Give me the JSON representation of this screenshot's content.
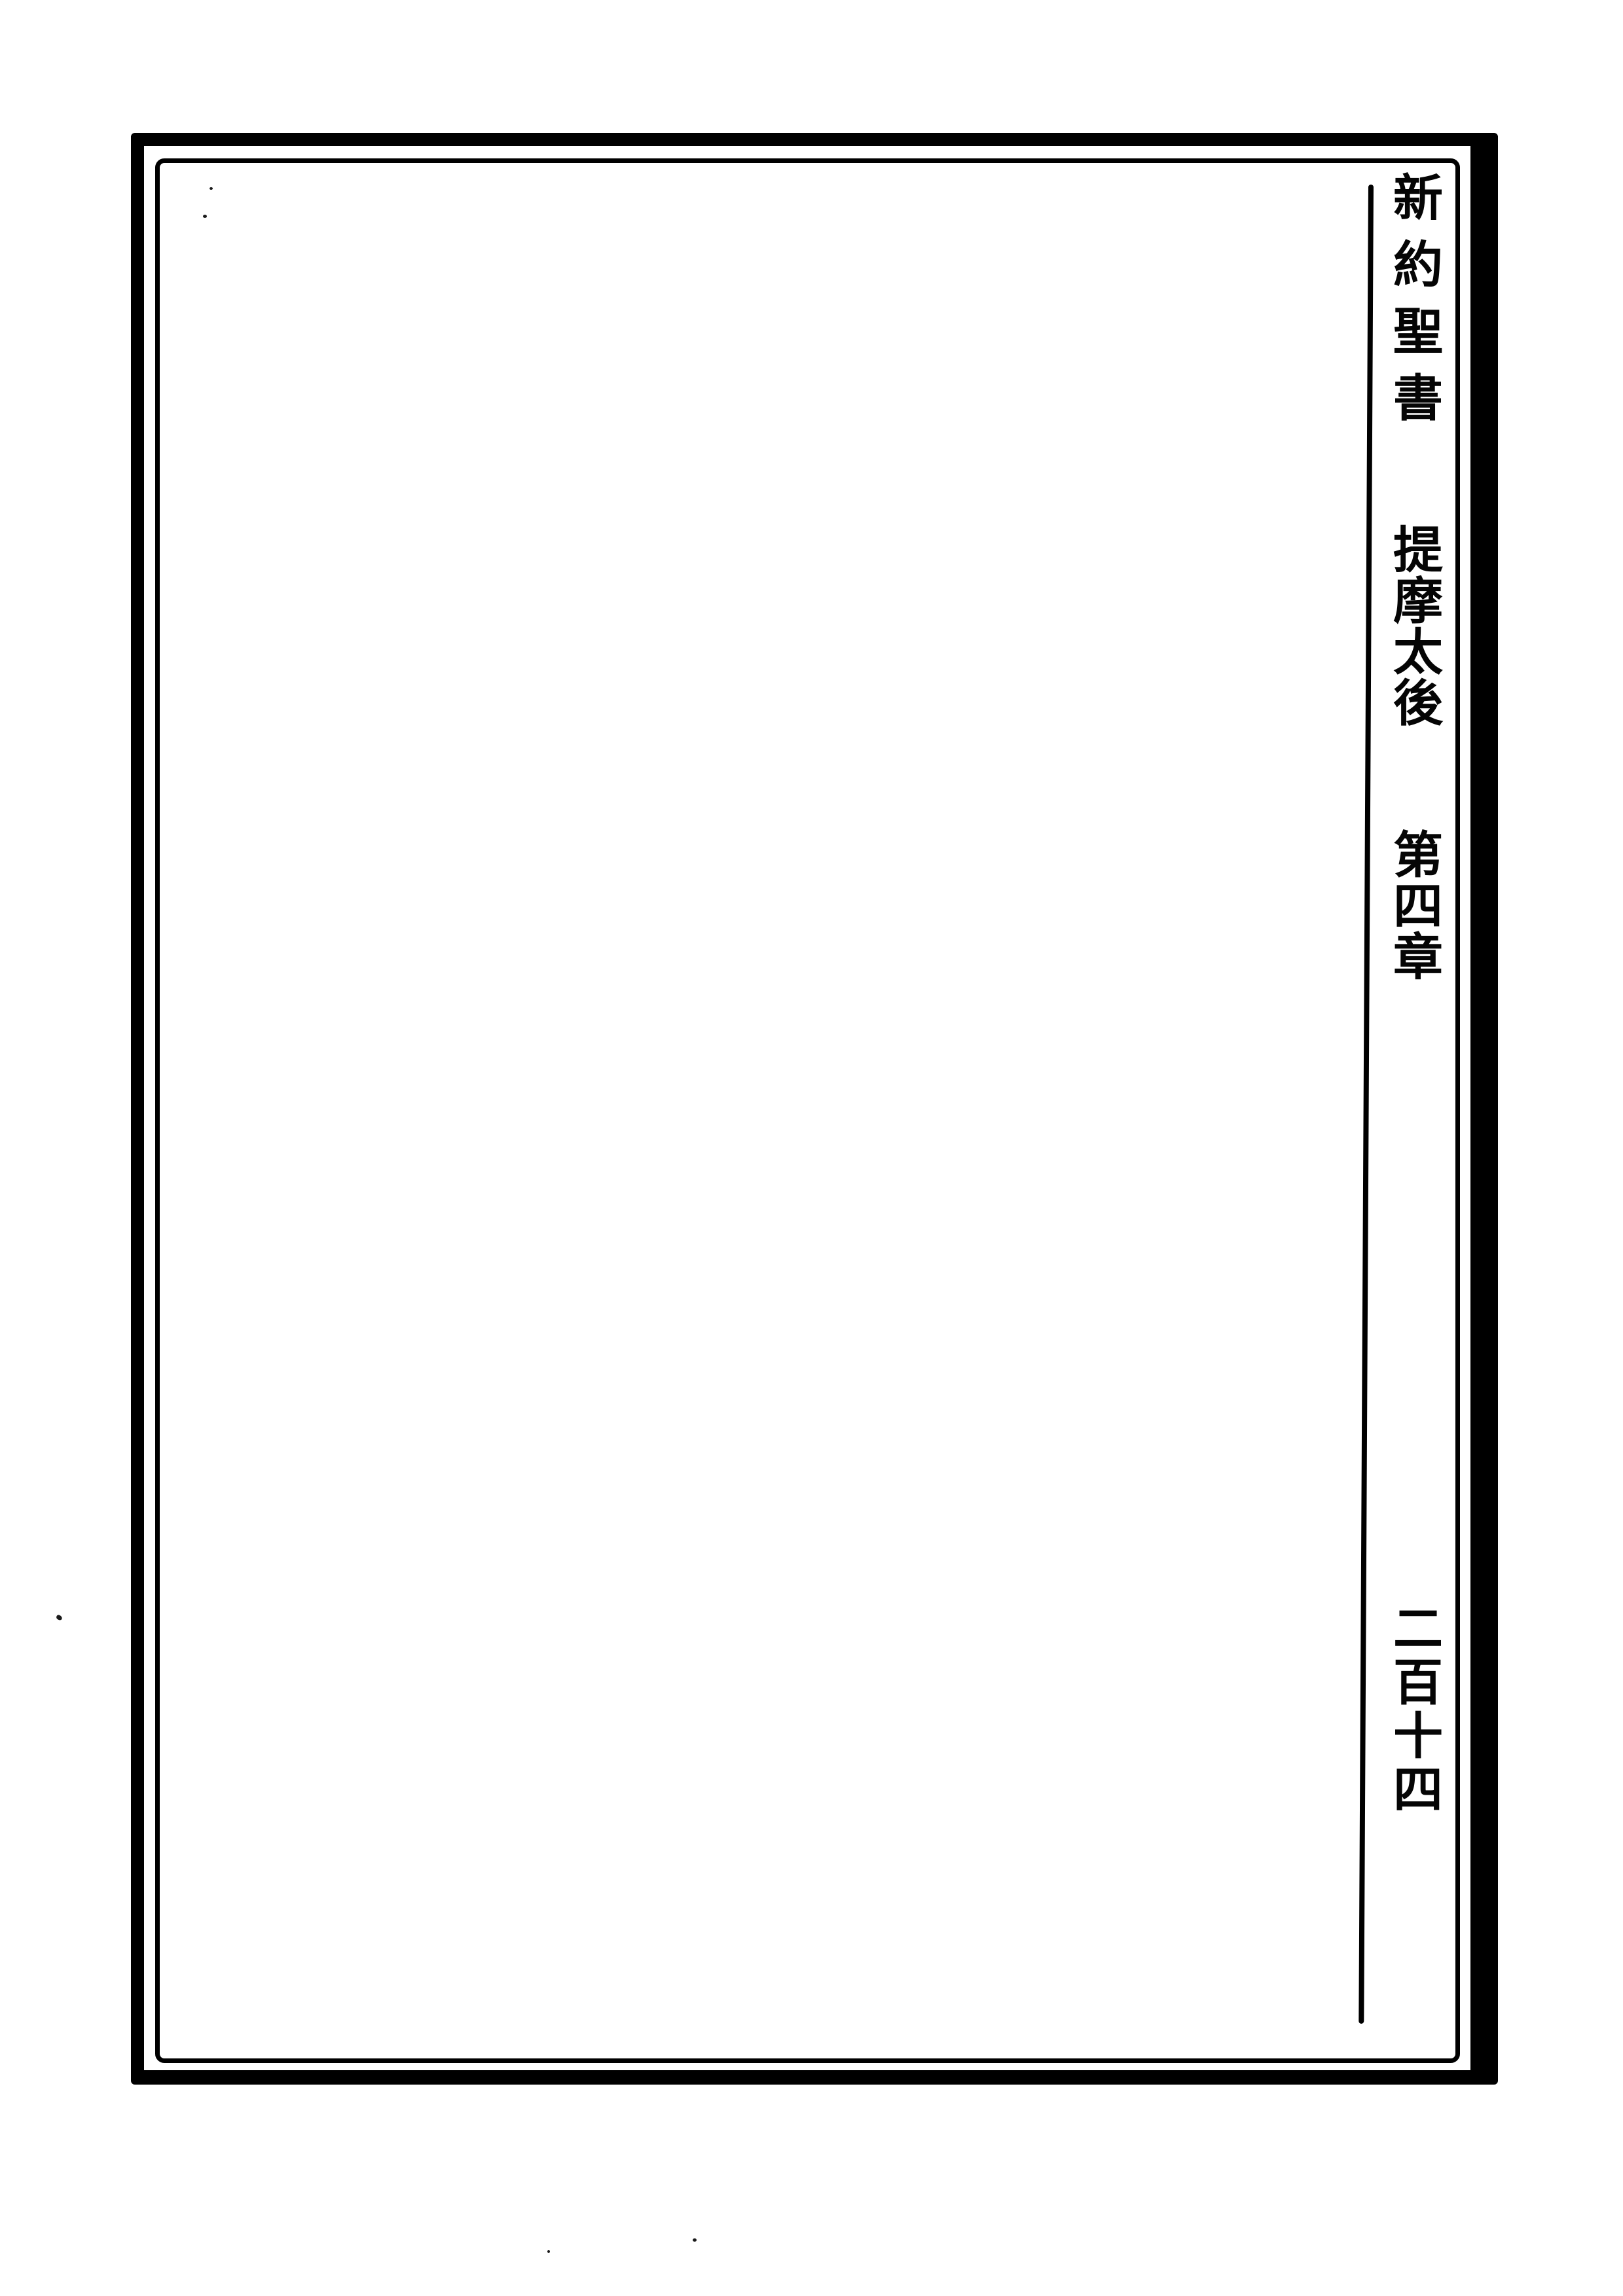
{
  "page": {
    "header_column": {
      "book_title": "新約聖書",
      "section_title": "提摩太後",
      "chapter_title": "第四章",
      "page_number": "二百十四"
    },
    "body_text": ""
  },
  "colors": {
    "ink": "#000000",
    "paper": "#ffffff"
  }
}
